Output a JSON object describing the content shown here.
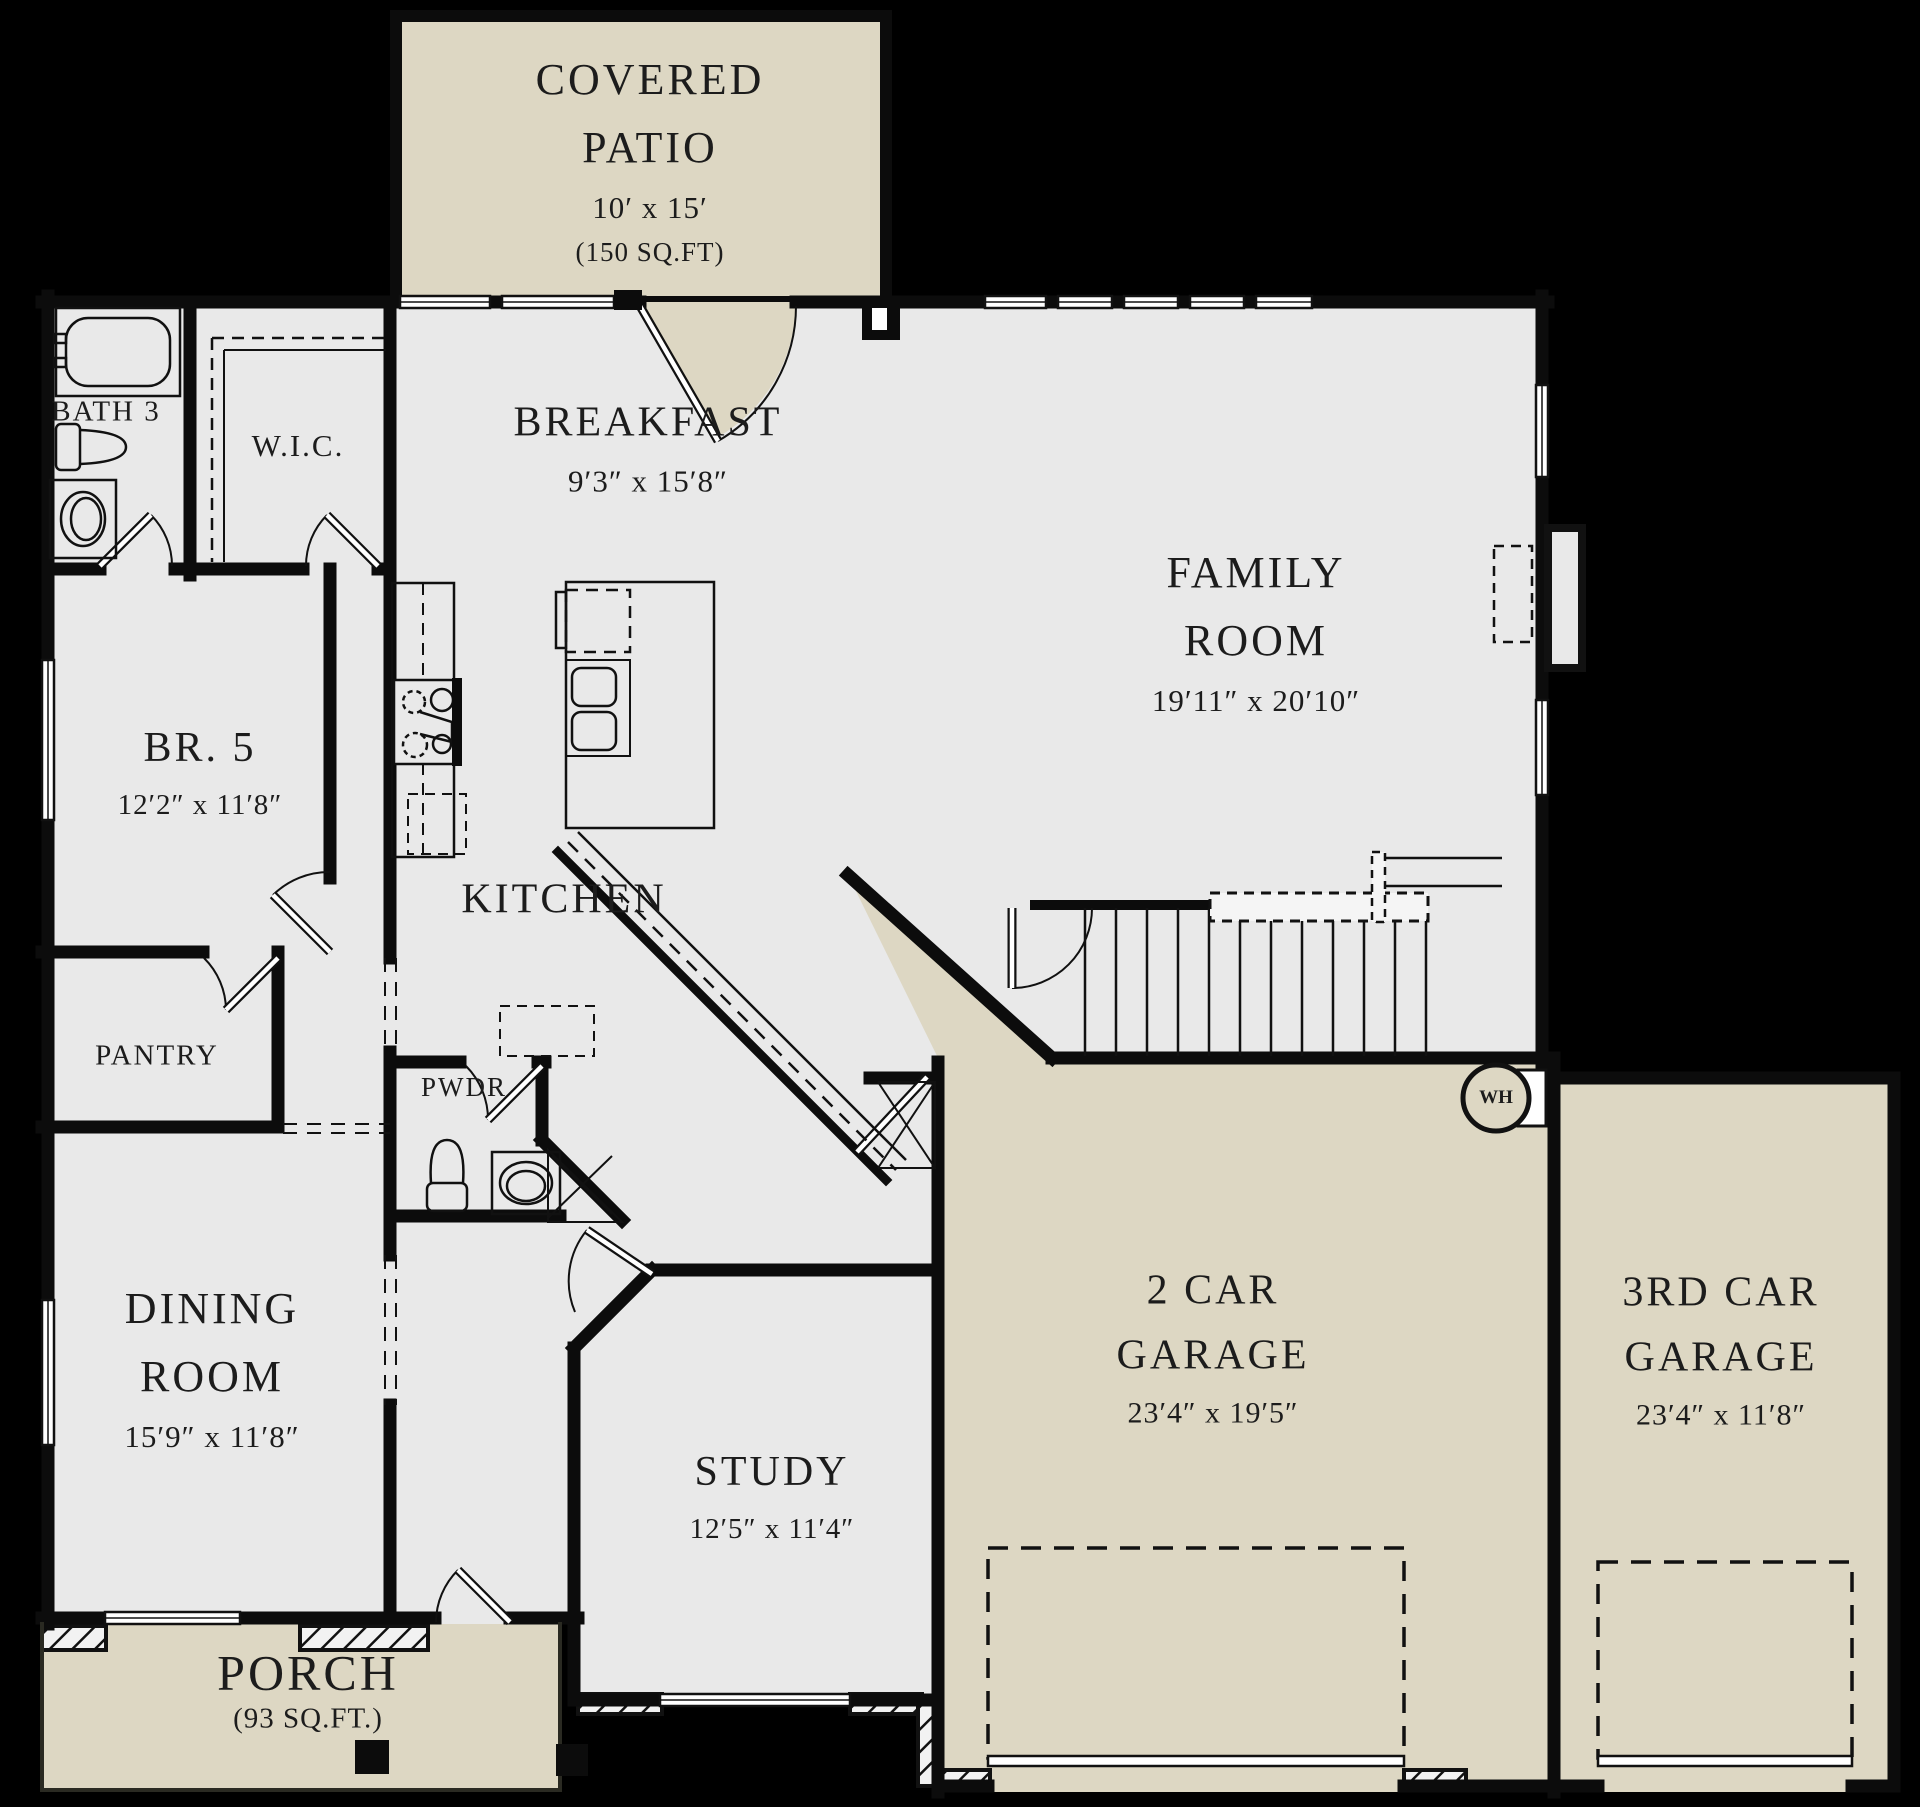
{
  "colors": {
    "background": "#000000",
    "interior_floor": "#e9e9e9",
    "outdoor_floor": "#ddd7c3",
    "wall": "#0c0c0c",
    "text": "#1c1c1c"
  },
  "rooms": {
    "patio": {
      "line1": "COVERED",
      "line2": "PATIO",
      "dims": "10′ x 15′",
      "area": "(150 SQ.FT)"
    },
    "breakfast": {
      "line1": "BREAKFAST",
      "dims": "9′3″ x 15′8″"
    },
    "family": {
      "line1": "FAMILY",
      "line2": "ROOM",
      "dims": "19′11″ x 20′10″"
    },
    "bath3": {
      "line1": "BATH 3"
    },
    "wic": {
      "line1": "W.I.C."
    },
    "br5": {
      "line1": "BR. 5",
      "dims": "12′2″ x 11′8″"
    },
    "kitchen": {
      "line1": "KITCHEN"
    },
    "pantry": {
      "line1": "PANTRY"
    },
    "pwdr": {
      "line1": "PWDR"
    },
    "dining": {
      "line1": "DINING",
      "line2": "ROOM",
      "dims": "15′9″ x 11′8″"
    },
    "study": {
      "line1": "STUDY",
      "dims": "12′5″ x 11′4″"
    },
    "garage2": {
      "line1": "2 CAR",
      "line2": "GARAGE",
      "dims": "23′4″ x 19′5″"
    },
    "garage3": {
      "line1": "3RD CAR",
      "line2": "GARAGE",
      "dims": "23′4″ x 11′8″"
    },
    "porch": {
      "line1": "PORCH",
      "area": "(93 SQ.FT.)"
    }
  },
  "annotations": {
    "water_heater": {
      "label": "WH"
    }
  }
}
